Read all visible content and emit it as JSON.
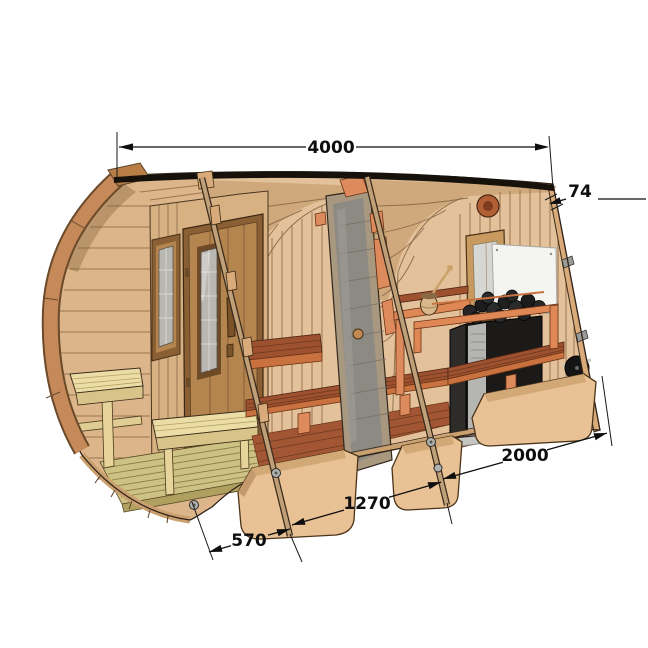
{
  "diagram": {
    "subject": "barrel-sauna-cutaway-technical-illustration",
    "background_color": "#ffffff",
    "dimensions": [
      {
        "id": "total-length",
        "label": "4000"
      },
      {
        "id": "wall-thickness",
        "label": "74"
      },
      {
        "id": "sauna-room-length",
        "label": "2000"
      },
      {
        "id": "middle-room-length",
        "label": "1270"
      },
      {
        "id": "porch-depth",
        "label": "570"
      }
    ],
    "components": [
      "porch-with-benches",
      "entrance-door-with-window",
      "porch-side-window",
      "middle-room-with-benches",
      "glass-door",
      "sauna-room",
      "wood-burning-stove-with-stones",
      "heat-shield",
      "sauna-window",
      "air-vent",
      "air-damper",
      "water-bucket-with-ladle",
      "support-cradles",
      "steel-bands"
    ],
    "colors": {
      "dimension_ink": "#0e0e0e",
      "wood_light": "#e3c19a",
      "wood_interior": "#dcb58a",
      "wood_ceiling": "#cfa87c",
      "trim_ring": "#c5895a",
      "section_cut_orange": "#dd8a5c",
      "bench_red": "#9e512f",
      "bench_edge_orange": "#c9713f",
      "porch_bench_yellow": "#ecdda6",
      "deck_olive": "#cdc183",
      "glass_gray": "#8d8983",
      "stove_black": "#1c1a18",
      "heat_shield_white": "#f4f4f1",
      "fire_orange": "#ff7d1f",
      "roof_ridge_dark": "#17110b"
    }
  }
}
